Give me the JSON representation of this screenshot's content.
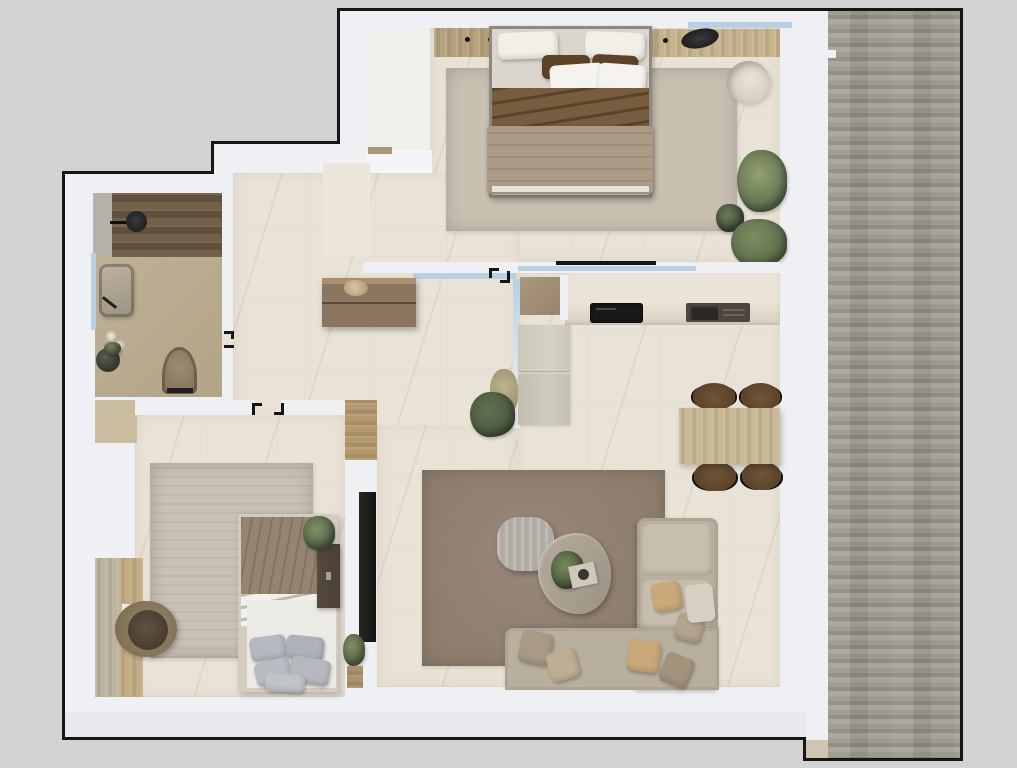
{
  "scene": {
    "type": "apartment-floor-plan-render",
    "view": "top-down",
    "rooms": [
      {
        "name": "master-bedroom",
        "position": "top-right",
        "furniture": [
          "double-bed",
          "wardrobe",
          "vanity-desk",
          "desk-chair",
          "round-pouf",
          "area-rug",
          "plants",
          "window"
        ]
      },
      {
        "name": "bathroom",
        "position": "top-left",
        "furniture": [
          "walk-in-shower",
          "shower-head",
          "sink-basin",
          "toilet",
          "window",
          "candles",
          "plant-kettle"
        ]
      },
      {
        "name": "hallway",
        "position": "center-left",
        "furniture": [
          "sideboard-dresser",
          "entry-alcove"
        ]
      },
      {
        "name": "kitchen-living-room",
        "position": "right",
        "furniture": [
          "kitchen-counter",
          "cooktop",
          "kitchen-sink",
          "tall-cabinets",
          "glass-partition",
          "dining-table",
          "dining-chairs",
          "corner-sofa",
          "coffee-tables",
          "area-rug",
          "tv-wall",
          "plants"
        ]
      },
      {
        "name": "second-bedroom",
        "position": "bottom-left",
        "furniture": [
          "single-bed",
          "nightstand",
          "desk",
          "desk-chair",
          "area-rug",
          "wardrobe-shelves",
          "plant"
        ]
      },
      {
        "name": "deck-terrace",
        "position": "right-edge",
        "furniture": []
      }
    ]
  },
  "colors": {
    "page": "#d3d3d3",
    "line": "#161616",
    "wall": "#eef0f4",
    "wall2": "#f4f5f8",
    "floor": "#e9e3d7",
    "floor2": "#ece6da",
    "nook": "#efefec",
    "bath-floor": "#b8a98c",
    "shower-wood": "#6e5b45",
    "tile": "#b5b2ac",
    "deck1": "#9d988e",
    "deck2": "#8f8a80",
    "deck3": "#a8a296",
    "step-wood": "#cfc5b2",
    "glass": "#b9d0e2",
    "wood": "#b5a17b",
    "wood2": "#c6b38c",
    "thresh": "#ab9878",
    "rug1": "#c9c0b2",
    "rug2": "#8e7e6e",
    "rug3": "#c7bfb1",
    "duvet": "#a6957f",
    "sheet-brown": "#6f5233",
    "pillow-brown": "#5d4428",
    "white-soft": "#f2efe9",
    "sheet-white": "#e6e2da",
    "mattress": "#dbd6cd",
    "bedframe": "#8e887d",
    "sofa": "#b9af9f",
    "sofa2": "#c8beae",
    "pillow-tan": "#c9a97a",
    "pillow-sage": "#a89a84",
    "table-gray": "#b7b2aa",
    "table-marble": "#a89f91",
    "dine-wood": "#c9b795",
    "chair-brown": "#5a4228",
    "chair-rim": "#6f5638",
    "cab1": "#ccc8b9",
    "cab2": "#c3bfb0",
    "counter1": "#eae4d8",
    "counter2": "#d8d1c0",
    "tan-block": "#a28f75",
    "dark": "#1d1b19",
    "plant": "#5c6c4c",
    "plant2": "#7d8c60",
    "plant3": "#4c5a40",
    "sink-dark": "#4e463c",
    "sink-basin": "#2b2724",
    "toilet": "#8d7d65",
    "night": "#4a4036",
    "desk-wood": "#c2ab83",
    "desk-wood2": "#bcb49f",
    "pouf": "#e2dccf",
    "pillow-gray": "#b5b9bf",
    "shade": "#e7e9ec",
    "sideboard": "#8b7660",
    "sideboard-top": "#a89071",
    "niche": "#c9bc9f"
  }
}
